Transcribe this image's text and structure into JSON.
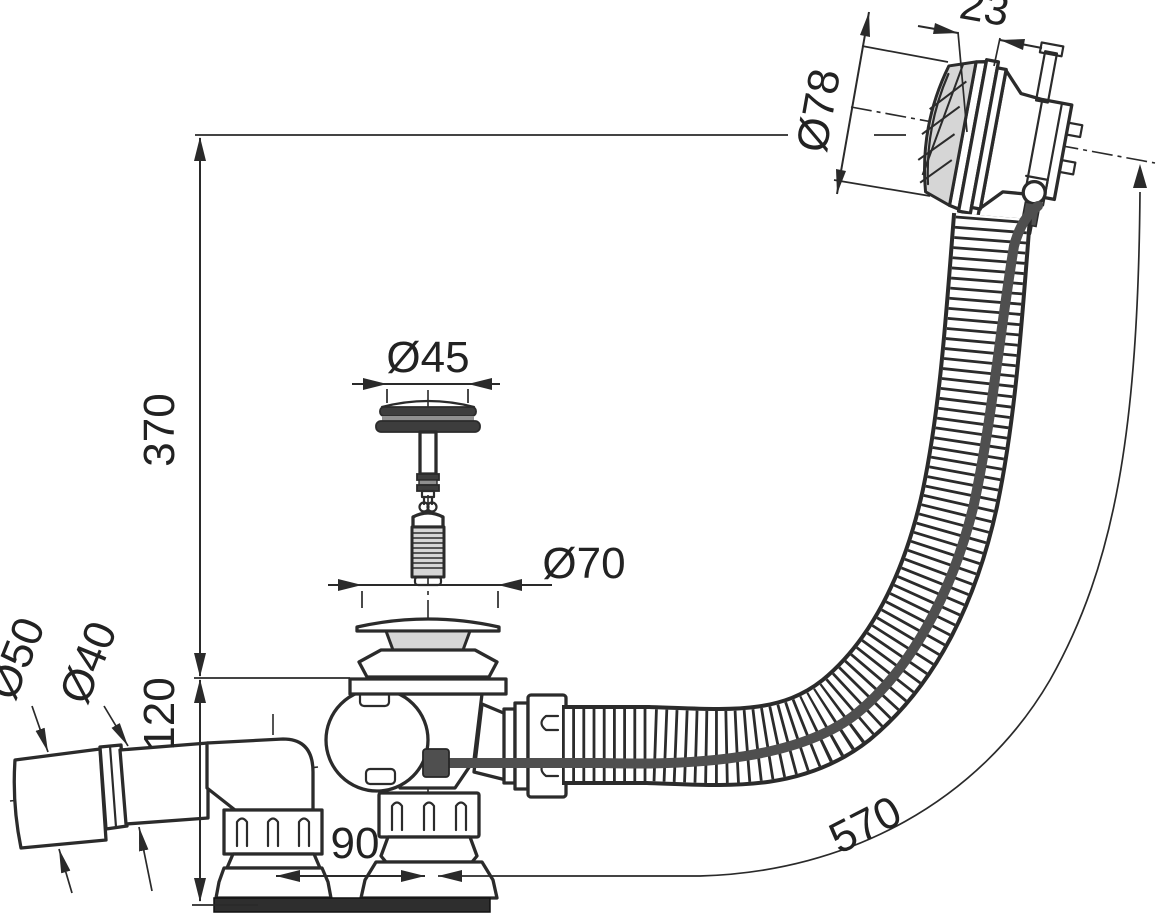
{
  "meta": {
    "title": "Bath waste and overflow set - dimensioned technical drawing",
    "background": "#ffffff"
  },
  "colors": {
    "line": "#2b2b2b",
    "light_fill": "#d6d6d6",
    "dark_fill": "#3d3d3d",
    "cable": "#4f4f4f"
  },
  "dims": {
    "height_overall": "370",
    "height_waste": "120",
    "offset_centers": "90",
    "hose_length": "570",
    "plug_diameter": "Ø45",
    "waste_flange_diameter": "Ø70",
    "outlet_sleeve_diameter": "Ø50",
    "outlet_pipe_diameter": "Ø40",
    "knob_depth": "23",
    "overflow_cover_diameter": "Ø78"
  }
}
